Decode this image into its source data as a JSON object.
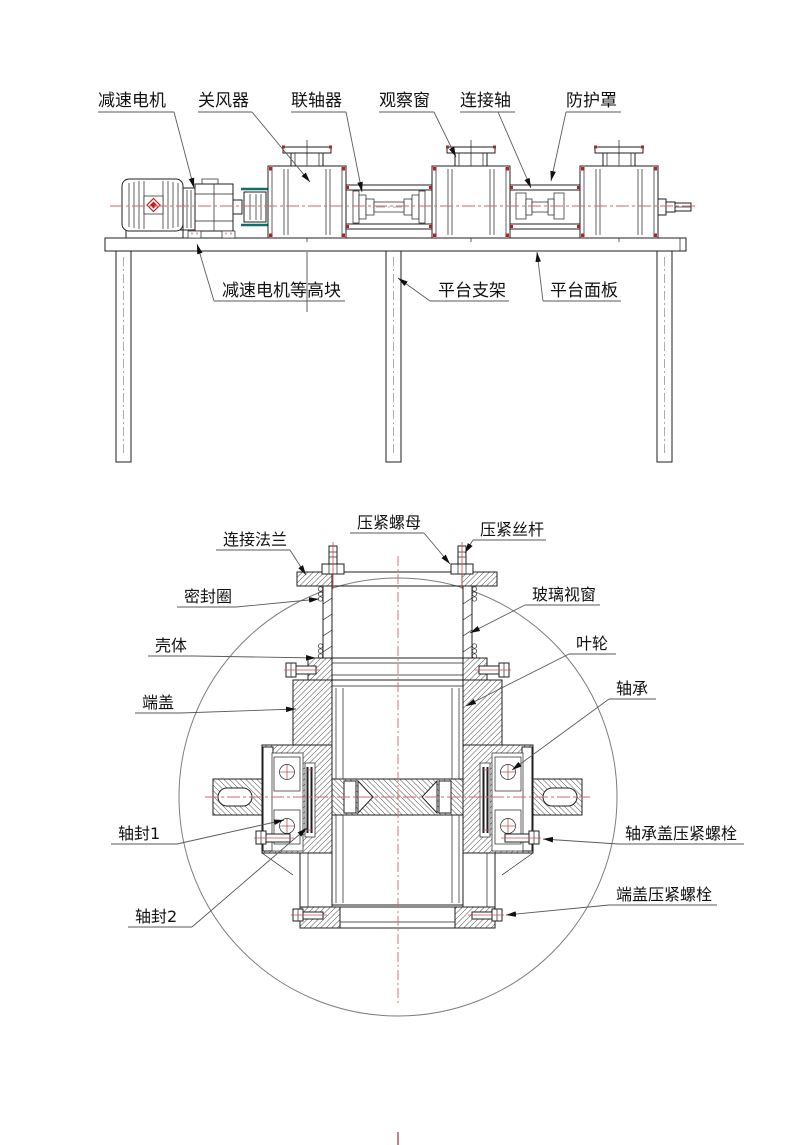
{
  "drawing": {
    "top_view": {
      "labels": {
        "gear_motor": "减速电机",
        "rotary_valve": "关风器",
        "coupling": "联轴器",
        "observation_window": "观察窗",
        "connecting_shaft": "连接轴",
        "protective_cover": "防护罩",
        "motor_leveling_block": "减速电机等高块",
        "platform_support": "平台支架",
        "platform_panel": "平台面板"
      }
    },
    "section_view": {
      "labels": {
        "connecting_flange": "连接法兰",
        "compression_nut": "压紧螺母",
        "compression_screw": "压紧丝杆",
        "seal_ring": "密封圈",
        "glass_window": "玻璃视窗",
        "housing": "壳体",
        "impeller": "叶轮",
        "end_cover": "端盖",
        "bearing": "轴承",
        "shaft_seal_1": "轴封1",
        "shaft_seal_2": "轴封2",
        "bearing_cover_bolt": "轴承盖压紧螺栓",
        "end_cover_bolt": "端盖压紧螺栓"
      }
    },
    "colors": {
      "line": "#1f1f1f",
      "centerline_red": "#cc6a6a",
      "accent_red": "#b22222",
      "teal": "#0f6f6f",
      "leveling_pink": "#cc6fae",
      "background": "#ffffff"
    }
  }
}
